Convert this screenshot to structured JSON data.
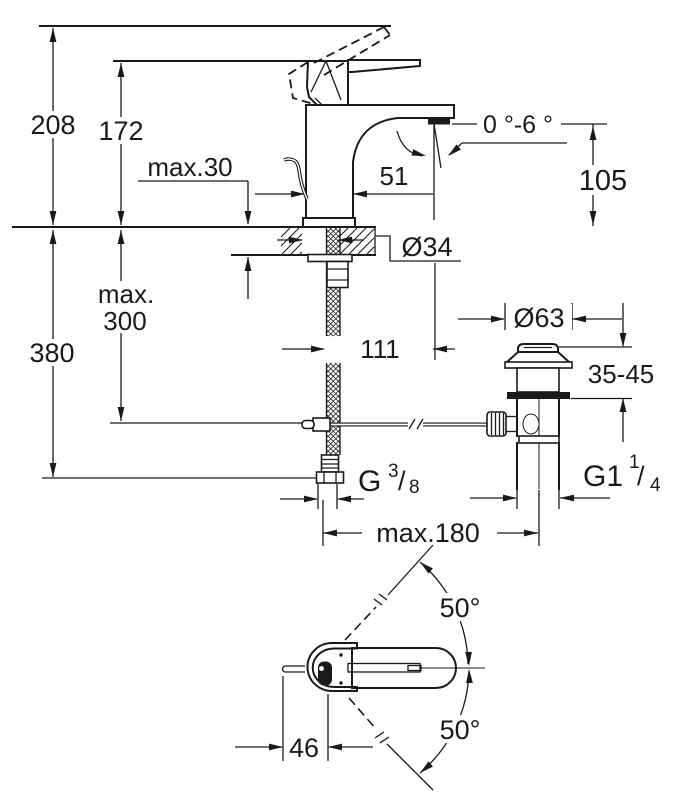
{
  "drawing": {
    "type": "technical dimension drawing",
    "subject": "single-lever basin mixer faucet with pop-up waste",
    "ink_color": "#1a1a1a",
    "background_color": "#ffffff"
  },
  "labels": {
    "height_total": "208",
    "height_to_handle": "172",
    "deck_max": "max.30",
    "body_width": "51",
    "spout_angle": "0 °-6 °",
    "outlet_to_deck": "105",
    "hole_dia": "Ø34",
    "under_total": "380",
    "hose_max_1": "max.",
    "hose_max_2": "300",
    "reach": "111",
    "waste_dia": "Ø63",
    "basin_range": "35-45",
    "rod_max": "max.180",
    "rod_offset": "46",
    "swivel_up": "50°",
    "swivel_down": "50°",
    "thread_supply": {
      "base": "G",
      "sup": "3",
      "slash": "/",
      "sub": "8"
    },
    "thread_waste": {
      "base": "G1",
      "sup": "1",
      "slash": "/",
      "sub": "4"
    }
  }
}
